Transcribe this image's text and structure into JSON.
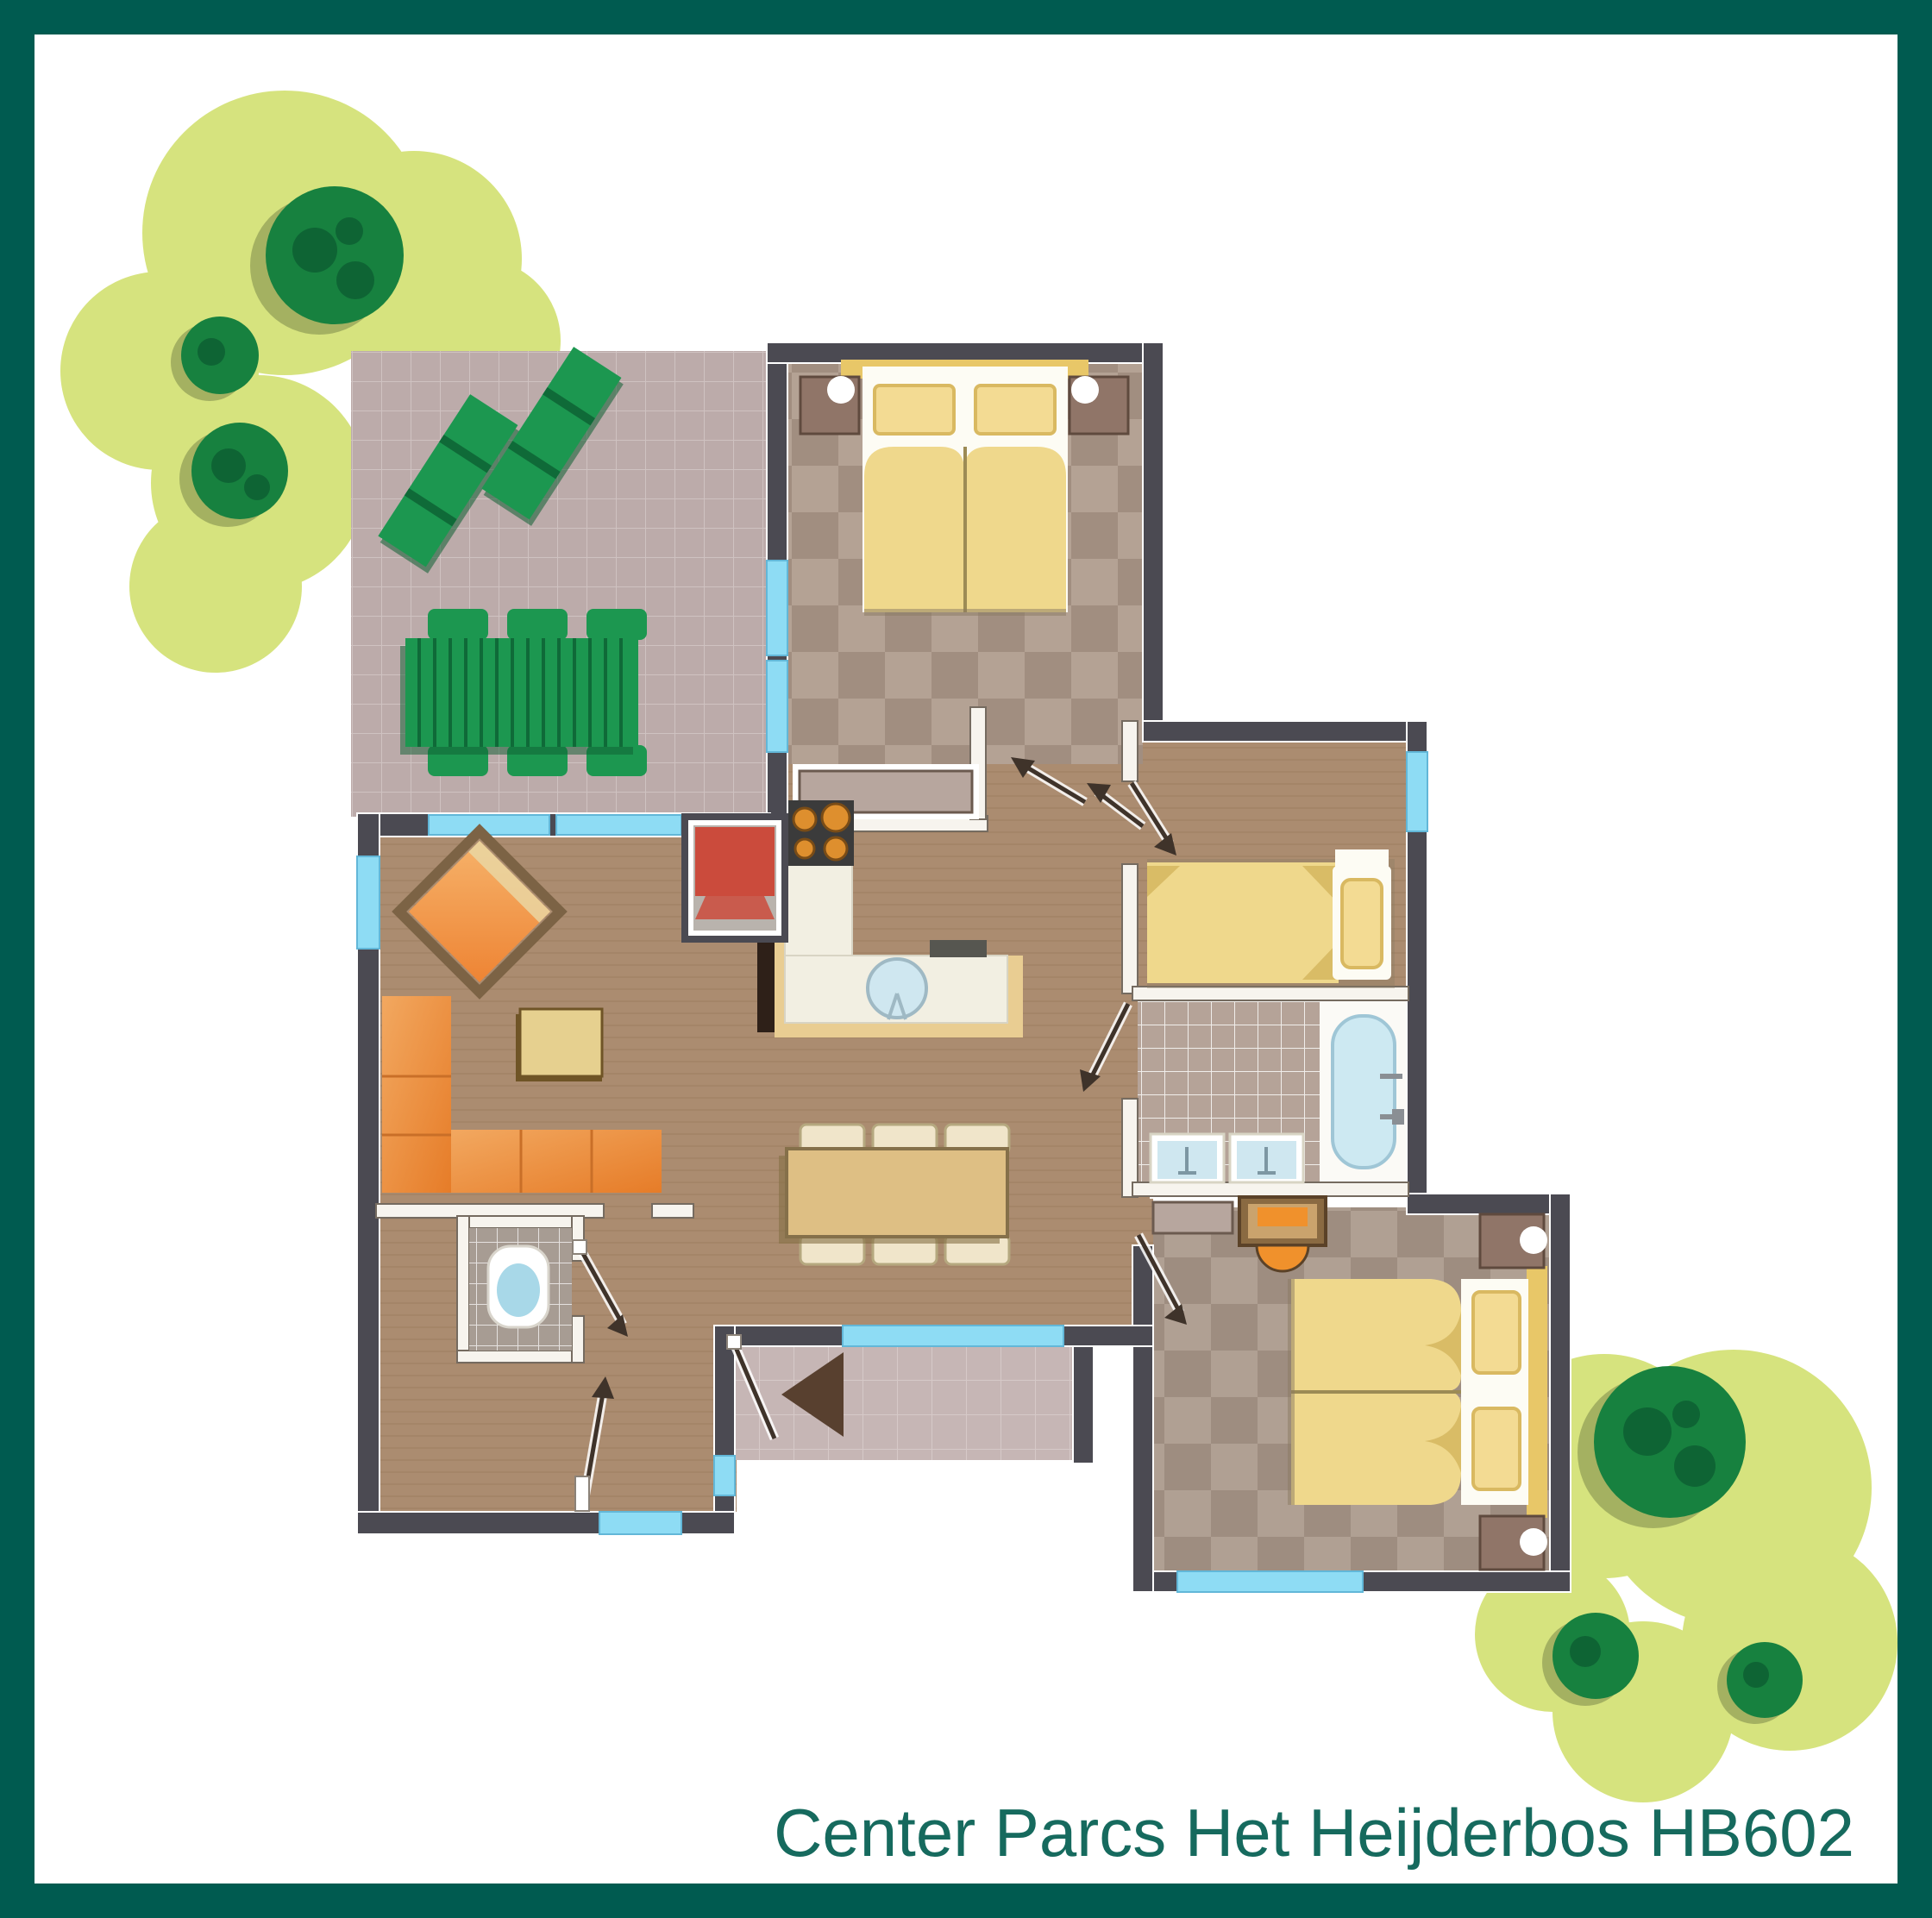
{
  "caption": "Center Parcs Het Heijderbos HB602",
  "palette": {
    "border": "#005b50",
    "caption": "#166a5e",
    "wall": "#4b4a52",
    "iwall": "#f7f4ee",
    "iwallEdge": "#756b60",
    "window": "#8edcf4",
    "windowEdge": "#62b7d8",
    "wood": "#ab8c70",
    "woodLine": "#9c7d60",
    "checkA": "#b4a294",
    "checkB": "#a18e80",
    "check3A": "#b0a093",
    "check3B": "#9e8d80",
    "terraceTile": "#bcabaa",
    "terraceLine": "#cfc2c1",
    "porchTile": "#c6b6b5",
    "porchLine": "#d6c9c8",
    "bathTile": "#b5a398",
    "wcTile": "#a79c93",
    "tileLine": "#ffffff",
    "blob": "#d6e37e",
    "tree": "#17813f",
    "treeDark": "#0e6434",
    "treeShadow": "#93a058",
    "green": "#1c9750",
    "greenDark": "#0f6a38",
    "sofa1": "#f2a860",
    "sofa2": "#e67c28",
    "chairFrame": "#7c6345",
    "tableTan": "#debf84",
    "tableEdge": "#85704a",
    "creamChair": "#f0e5ca",
    "creamChairEdge": "#b5a87f",
    "counter": "#f2efe2",
    "counterBase": "#e9cd92",
    "stove": "#3b3b3b",
    "burner": "#de8f2e",
    "sink": "#cfe7f0",
    "sinkEdge": "#9fb9c4",
    "linen": "#fdfcf4",
    "duvet": "#efd88c",
    "duvetFold": "#d9bc66",
    "pillow": "#f3db93",
    "pillowEdge": "#d9b961",
    "headboard": "#e8c768",
    "nightstand": "#907568",
    "nightstandEdge": "#5f4a3e",
    "red": "#cb4b3c",
    "doorLine": "#3f332a",
    "triangle": "#58402f",
    "dresser": "#b7a69e",
    "desk": "#8a6a42",
    "deskTan": "#caa36d",
    "deskOrange": "#f0912c",
    "tub": "#cde9f2",
    "tubEdge": "#9fc6d6",
    "fixture": "#8a8f94"
  },
  "elements": {
    "rooms": [
      "terrace",
      "bedroom-top",
      "hallway",
      "kitchen",
      "living-room",
      "dining-area",
      "bedroom-middle",
      "bathroom",
      "bedroom-bottom",
      "toilet",
      "entrance-porch",
      "garden"
    ],
    "furniture": [
      "sun-lounger",
      "garden-table",
      "garden-chair",
      "double-bed",
      "single-bed",
      "wardrobe",
      "stove",
      "kitchen-counter",
      "sink",
      "fridge",
      "fireplace-chair",
      "corner-sofa",
      "armchair",
      "coffee-table",
      "dining-table",
      "dining-chair",
      "toilet",
      "bathtub",
      "washbasin",
      "desk",
      "stool",
      "tree",
      "shrub"
    ]
  }
}
